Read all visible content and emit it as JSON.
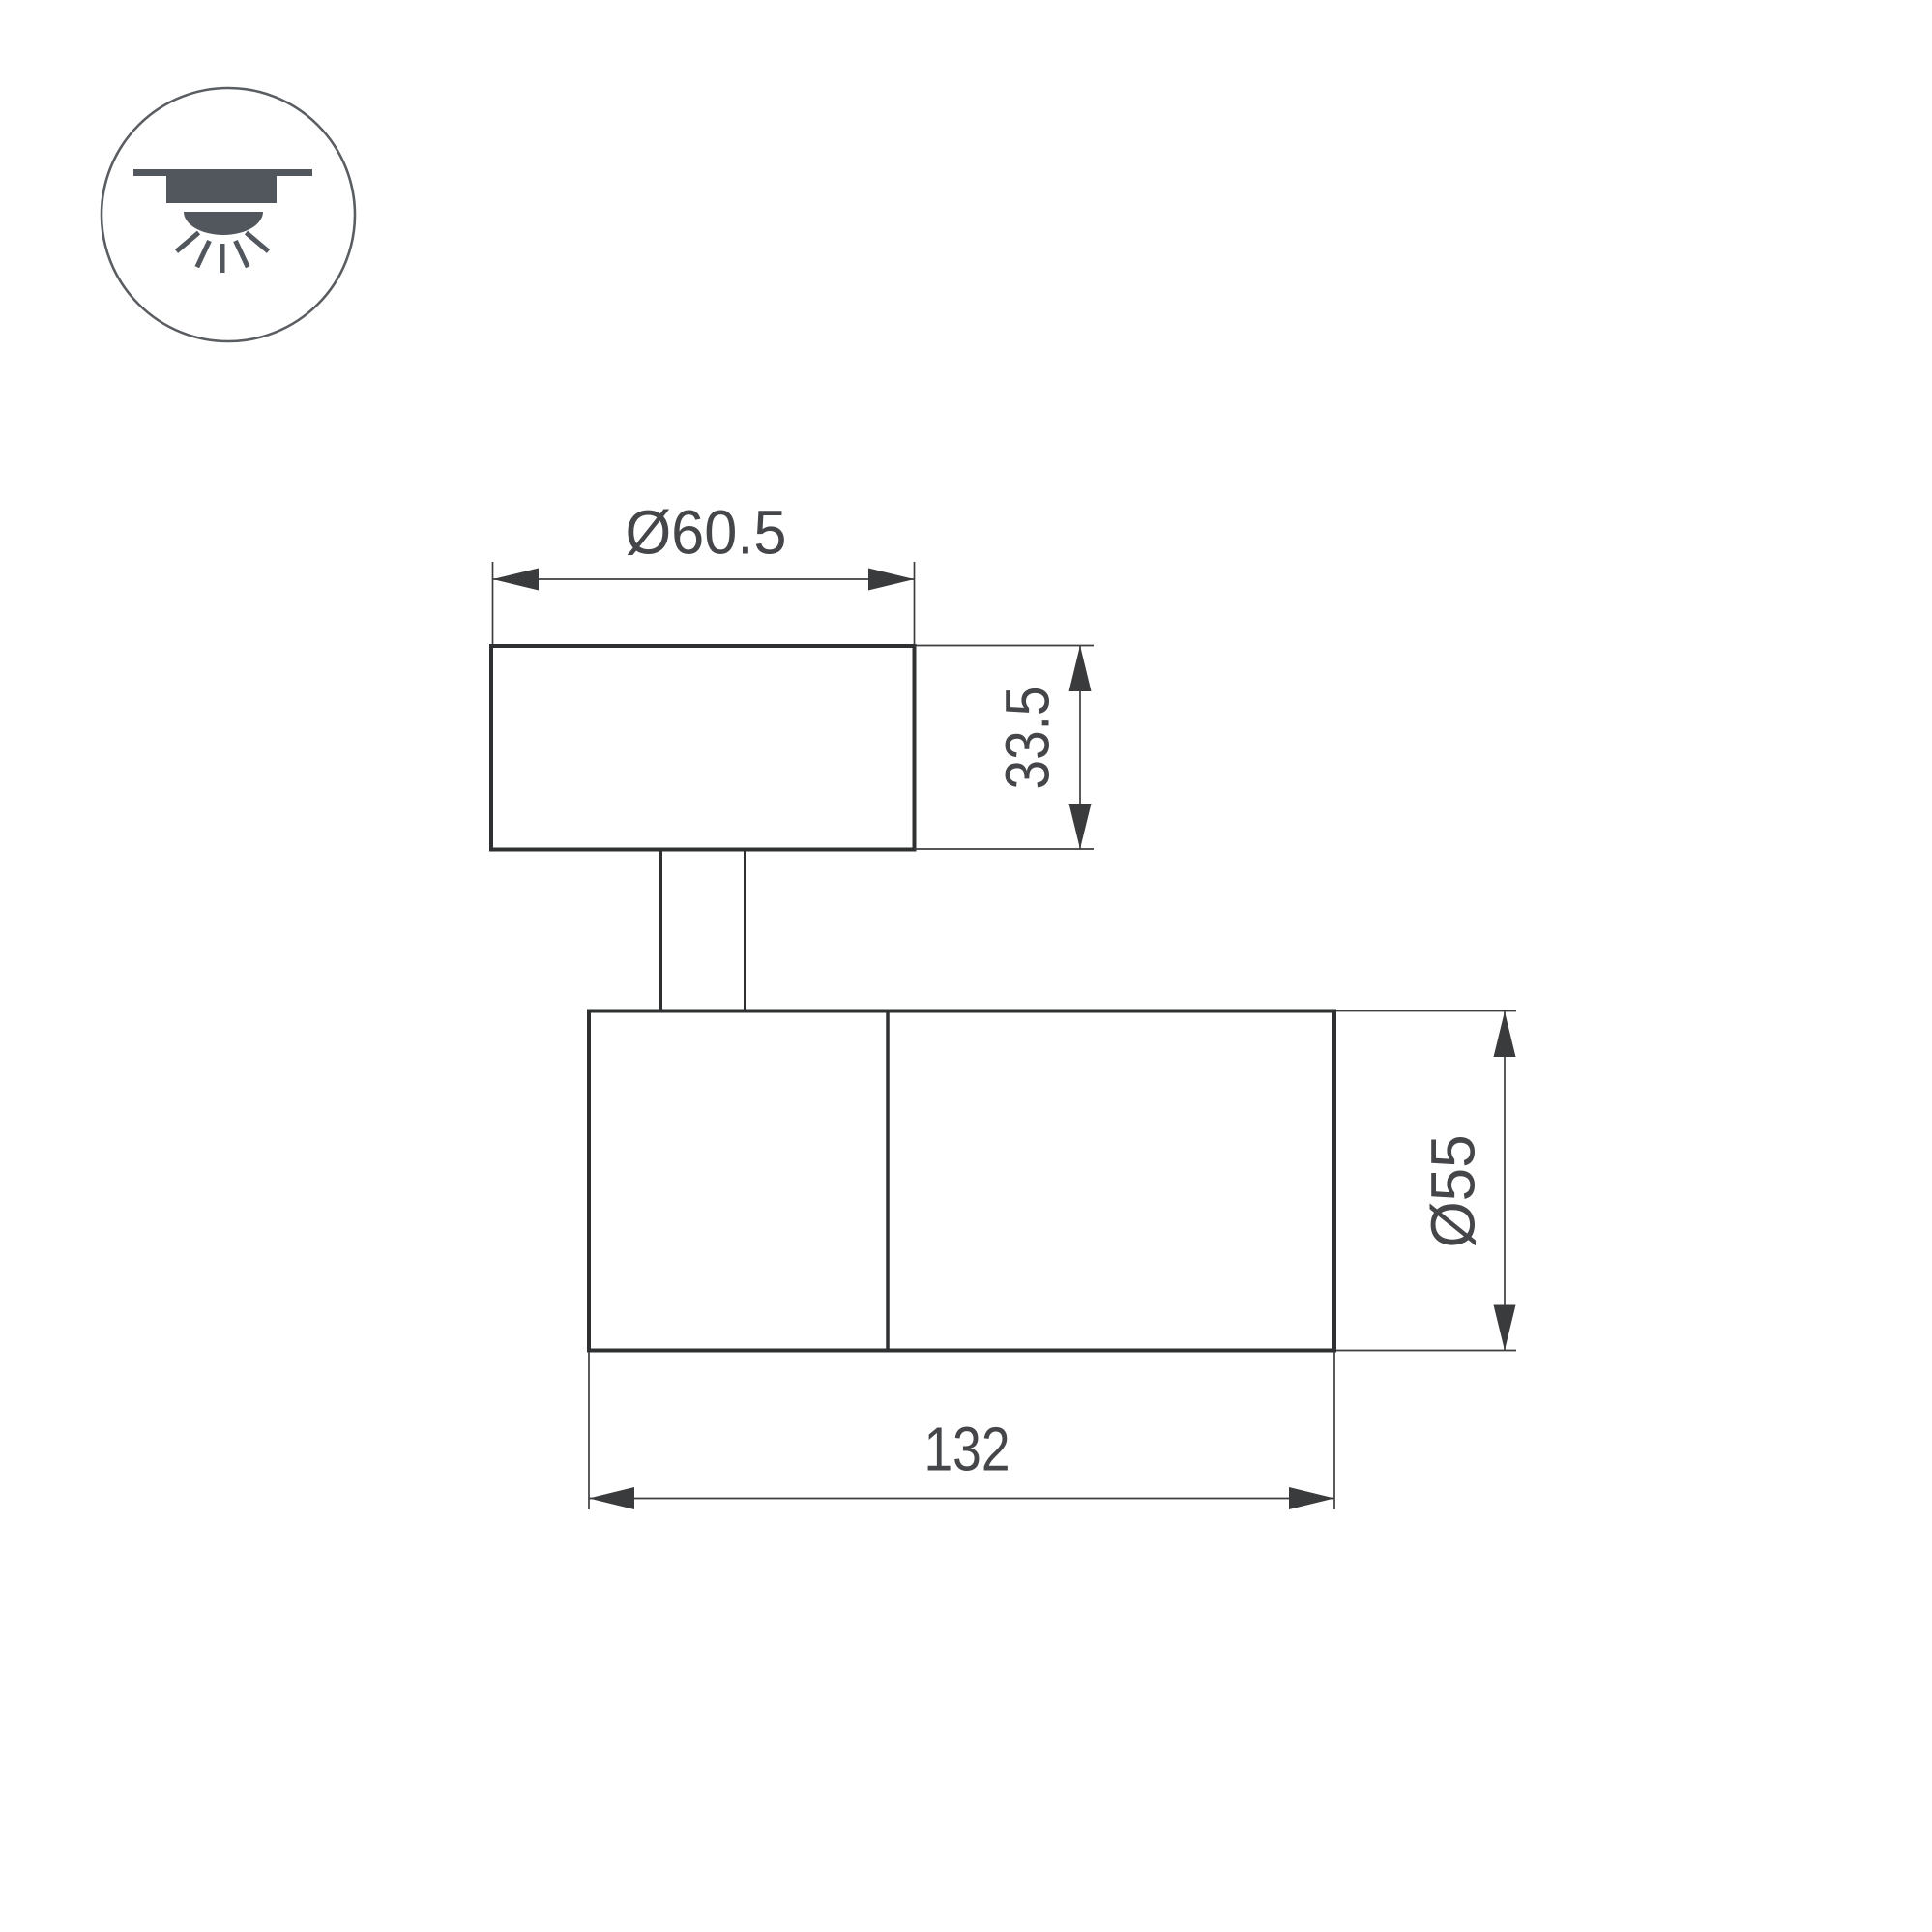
{
  "page": {
    "background": "#ffffff",
    "kind": "technical-dimension-drawing"
  },
  "palette": {
    "outline": "#2f3032",
    "dimension_lines": "#3d3e40",
    "text": "#454649",
    "icon_gray": "#51575c"
  },
  "icon": {
    "label": "surface-mounted-ceiling-light"
  },
  "dimensions": {
    "canopy_diameter": "Ø60.5",
    "canopy_height": "33.5",
    "body_diameter": "Ø55",
    "body_length": "132"
  }
}
